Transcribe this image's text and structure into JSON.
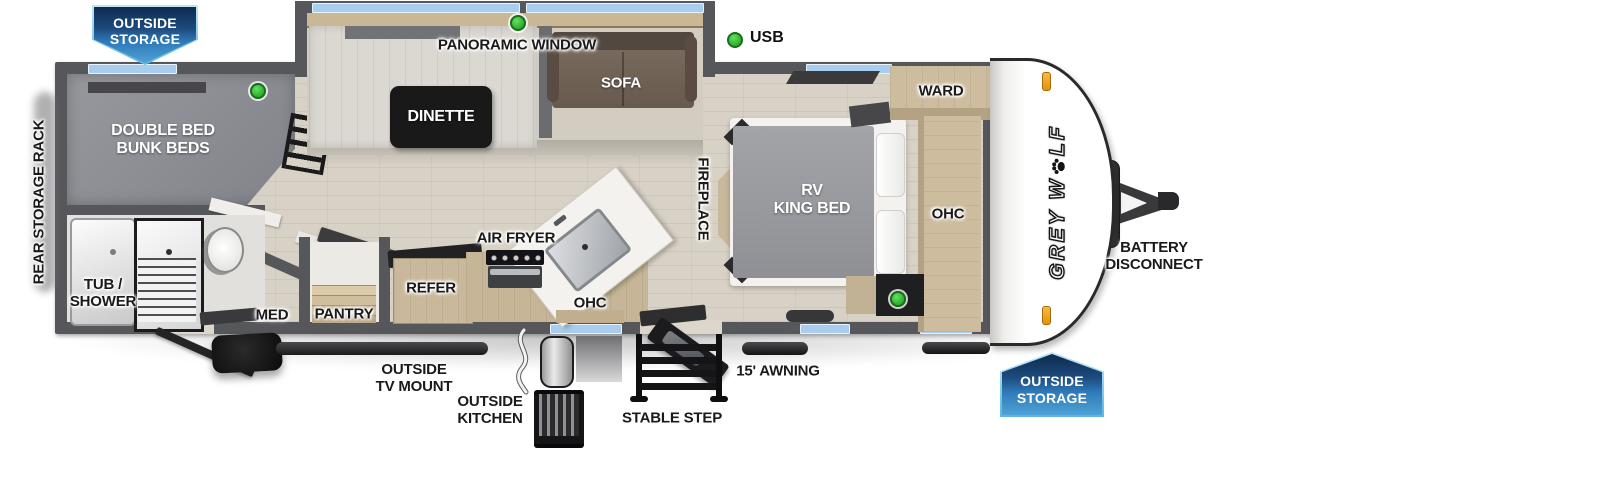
{
  "badges": {
    "top_left": "OUTSIDE\nSTORAGE",
    "bottom_right": "OUTSIDE\nSTORAGE"
  },
  "legend": {
    "usb": "USB"
  },
  "brand": {
    "logo_prefix": "GREY W",
    "logo_suffix": "LF"
  },
  "exterior_labels": {
    "rear_storage_rack": "REAR STORAGE RACK",
    "outside_tv_mount": "OUTSIDE\nTV MOUNT",
    "outside_kitchen": "OUTSIDE\nKITCHEN",
    "stable_step": "STABLE STEP",
    "awning": "15' AWNING",
    "battery_disconnect": "BATTERY\nDISCONNECT"
  },
  "interior_labels": {
    "panoramic_window": "PANORAMIC WINDOW",
    "dinette": "DINETTE",
    "sofa": "SOFA",
    "double_bunk": "DOUBLE BED\nBUNK BEDS",
    "tub_shower": "TUB /\nSHOWER",
    "med": "MED",
    "pantry": "PANTRY",
    "refer": "REFER",
    "air_fryer": "AIR FRYER",
    "ohc_kitchen": "OHC",
    "fireplace": "FIREPLACE",
    "rv_king_bed": "RV\nKING BED",
    "ward": "WARD",
    "ohc_bedroom": "OHC"
  },
  "colors": {
    "wall_gray": "#56575a",
    "floor_wood": "#d8d1c5",
    "window_blue": "#a9cdee",
    "badge_blue": "#2e79b8",
    "usb_green": "#3ec73e",
    "clearance_orange": "#f09e1d"
  }
}
